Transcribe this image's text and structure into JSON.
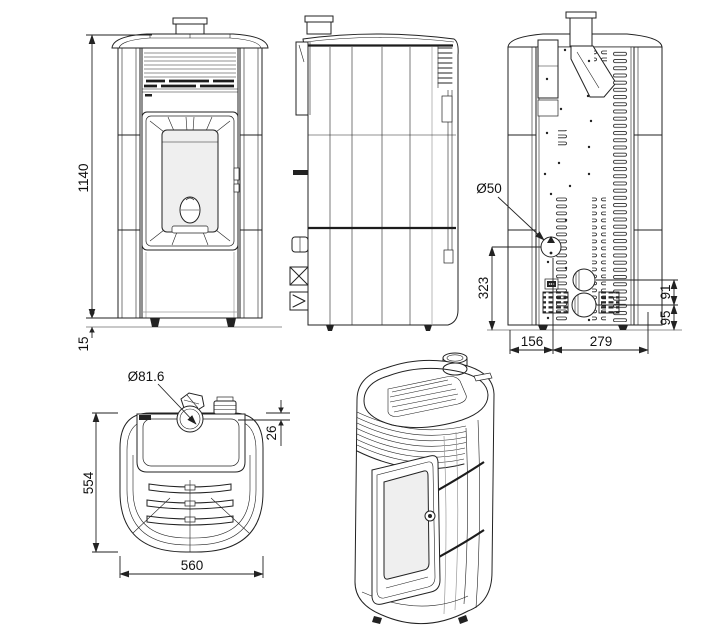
{
  "meta": {
    "title": "Pellet stove multi-view dimensional drawing"
  },
  "colors": {
    "line": "#222222",
    "background": "#ffffff",
    "glass": "#efefef"
  },
  "dimensions": {
    "front": {
      "overall_height": "1140",
      "foot_height": "15"
    },
    "rear": {
      "air_intake_diameter": "Ø50",
      "intake_center_height": "323",
      "bottom_span_left": "156",
      "bottom_span_right": "279",
      "outlet_spacing": "91",
      "outlet_center_height": "95"
    },
    "top": {
      "flue_collar_diameter": "Ø81.6",
      "flue_front_offset": "26",
      "depth": "554",
      "width": "560"
    }
  }
}
